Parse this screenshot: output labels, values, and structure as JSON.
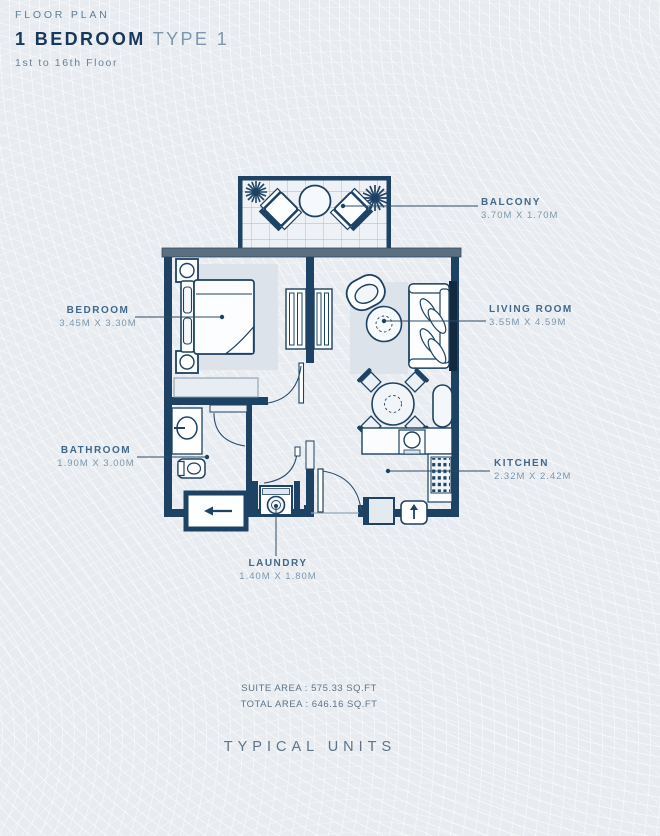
{
  "header": {
    "eyebrow": "FLOOR PLAN",
    "title_bold": "1 BEDROOM",
    "title_light": "TYPE 1",
    "subtitle": "1st to 16th Floor"
  },
  "rooms": {
    "balcony": {
      "name": "BALCONY",
      "dims": "3.70M X 1.70M"
    },
    "bedroom": {
      "name": "BEDROOM",
      "dims": "3.45M X 3.30M"
    },
    "living_room": {
      "name": "LIVING ROOM",
      "dims": "3.55M X 4.59M"
    },
    "bathroom": {
      "name": "BATHROOM",
      "dims": "1.90M X 3.00M"
    },
    "kitchen": {
      "name": "KITCHEN",
      "dims": "2.32M X 2.42M"
    },
    "laundry": {
      "name": "LAUNDRY",
      "dims": "1.40M X 1.80M"
    }
  },
  "areas": {
    "suite": "SUITE AREA : 575.33 SQ.FT",
    "total": "TOTAL AREA : 646.16 SQ.FT"
  },
  "footer": {
    "label": "TYPICAL UNITS"
  },
  "colors": {
    "wall_navy": "#1d4263",
    "wall_gray": "#5c6f81",
    "label_text": "#41688a",
    "dim_text": "#7b97ad",
    "rug": "#dde3ea",
    "background": "#e8ecf0"
  }
}
